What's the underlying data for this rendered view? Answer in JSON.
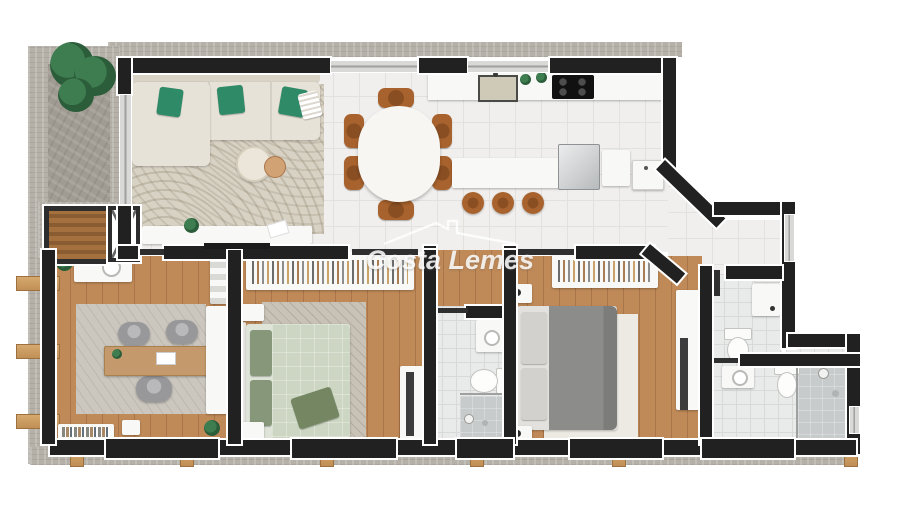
{
  "watermark": {
    "text": "Costa Lemes",
    "icon": "roof-outline"
  },
  "palette": {
    "wall": "#212121",
    "wall_outline": "#ffffff",
    "door_leaf": "#2f2f2f",
    "concrete": "#b5b1a8",
    "stone": "#a19c93",
    "tile": "#f0efed",
    "tile_line": "#e2e1de",
    "wood": "#c08a58",
    "wood_line": "#a9754a",
    "wood_light": "#d1a273",
    "bath": "#e9eaea",
    "bath_line": "#d8dada",
    "shower": "#c7cbcc",
    "rug_living": "#d8d2c5",
    "rug_bed": "#c8c2b7",
    "rug_office": "#cbc7bf",
    "rug_master": "#edeae4",
    "furn_white": "#f8f8f6",
    "sofa": "#e7e2d7",
    "sofa_dark": "#d9d3c6",
    "green": "#2f8a68",
    "sage": "#ccd6c2",
    "sage_light": "#dfe4d8",
    "sage_dark": "#87977a",
    "gray_bed": "#8c8c8a",
    "gray_pillow": "#d3d1cd",
    "headboard": "#e9e7e3",
    "chair_brown": "#a8622d",
    "chair_brown_dark": "#8a4e23",
    "office_chair": "#98989a",
    "desk_wood": "#c49a6c",
    "appliance_black": "#1b1b1b",
    "beam": "#d6a96e",
    "window_glass": "#d9d9d7",
    "glass_line": "#9fa0a0",
    "plant": "#3e7d4f",
    "plant_dark": "#2c5d3a",
    "watermark_color": "rgba(255,255,255,0.85)"
  },
  "scene": {
    "type": "apartment-floor-plan-3d-render",
    "areas": [
      {
        "name": "balcony-terrace",
        "items": [
          "potted-plant"
        ]
      },
      {
        "name": "stair-elevator-core",
        "items": [
          "stairwell",
          "elevator"
        ]
      },
      {
        "name": "living-room",
        "items": [
          "l-shaped-sofa",
          "green-cushions",
          "area-rug",
          "coffee-tables",
          "tv-console",
          "tv"
        ]
      },
      {
        "name": "dining-area",
        "items": [
          "oval-table",
          "six-chairs"
        ]
      },
      {
        "name": "kitchen",
        "items": [
          "sink",
          "cooktop",
          "island",
          "three-bar-stools",
          "refrigerator",
          "cabinet",
          "utility-tub"
        ]
      },
      {
        "name": "laundry-nook",
        "items": [
          "laundry-tub",
          "shelf"
        ]
      },
      {
        "name": "guest-wc",
        "items": [
          "toilet"
        ]
      },
      {
        "name": "suite-bathroom",
        "items": [
          "vanity-sink",
          "toilet",
          "walk-in-shower"
        ]
      },
      {
        "name": "hall-bathroom",
        "items": [
          "vanity-sink",
          "toilet",
          "walk-in-shower"
        ]
      },
      {
        "name": "master-bedroom",
        "items": [
          "double-bed",
          "open-wardrobe",
          "nightstands",
          "rug",
          "desk-tv"
        ]
      },
      {
        "name": "second-bedroom",
        "items": [
          "double-bed",
          "open-wardrobe",
          "nightstands",
          "rug",
          "desk-tv"
        ]
      },
      {
        "name": "office-room",
        "items": [
          "desk",
          "three-chairs",
          "rug",
          "counter-sink",
          "closet",
          "bookshelf",
          "plants"
        ]
      }
    ]
  }
}
